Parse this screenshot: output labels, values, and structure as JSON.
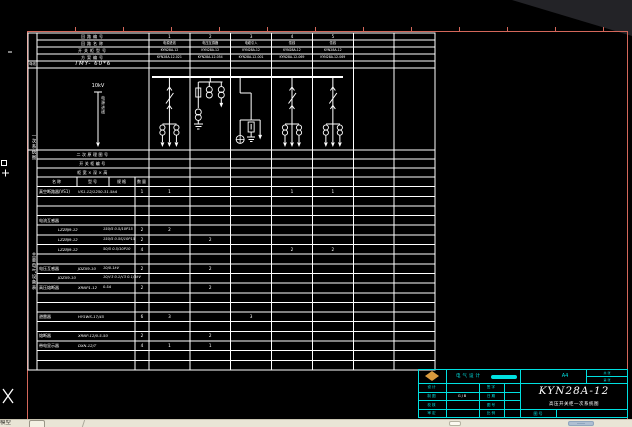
{
  "app": {
    "model_tab_label": "模型"
  },
  "colors": {
    "frame": "#d4675a",
    "drawing_lines": "#ffffff",
    "title_block": "#00e0e0",
    "logo": "#d99a3d",
    "taskbar": "#e9e5d6",
    "scroll_thumb": "#aebfd2"
  },
  "drawing": {
    "bus_label": "母线",
    "bus_spec": "TMY- 60*6",
    "incoming_voltage": "10kV",
    "incoming_note": "电源进线",
    "section_label_primary": "一次系统图",
    "section_label_equipment": "主要电气设备表",
    "header_rows": [
      {
        "label": "回路编号",
        "cells": [
          "1",
          "2",
          "3",
          "4",
          "5",
          "",
          ""
        ]
      },
      {
        "label": "回路名称",
        "cells": [
          "电源进线",
          "电压互感器",
          "电缆引入",
          "馈线",
          "馈线",
          "",
          ""
        ]
      },
      {
        "label": "开关柜型号",
        "cells": [
          "KYN28A-12",
          "KYN28A-12",
          "KYN28A-12",
          "KYN28A-12",
          "KYN28A-12",
          "",
          ""
        ]
      },
      {
        "label": "方案编号",
        "cells": [
          "KYN28A-12-021",
          "KYN28A-12-054",
          "KYN28A-12-001",
          "KYN28A-12-069",
          "KYN28A-12-069",
          "",
          ""
        ]
      }
    ],
    "scheme_diagrams": [
      "breaker",
      "pt",
      "cable",
      "breaker",
      "breaker",
      "",
      ""
    ],
    "info_rows": [
      {
        "label": "二次原理图号"
      },
      {
        "label": "开关柜编号"
      },
      {
        "label": "柜宽×深×高"
      }
    ],
    "equipment_headers": [
      "名称",
      "型号",
      "规格",
      "数量"
    ],
    "equipment_rows": [
      {
        "name": "真空断路器(VS1)",
        "model": "VS1-12/1250-31.5kA",
        "spec": "",
        "qty": "1",
        "per_scheme": [
          "1",
          "",
          "",
          "1",
          "1",
          "",
          ""
        ]
      },
      {
        "name": "",
        "model": "",
        "spec": "",
        "qty": "",
        "per_scheme": [
          "",
          "",
          "",
          "",
          "",
          "",
          ""
        ]
      },
      {
        "name": "",
        "model": "",
        "spec": "",
        "qty": "",
        "per_scheme": [
          "",
          "",
          "",
          "",
          "",
          "",
          ""
        ]
      },
      {
        "name": "电流互感器",
        "model": "",
        "spec": "",
        "qty": "",
        "per_scheme": [
          "",
          "",
          "",
          "",
          "",
          "",
          ""
        ]
      },
      {
        "name": "",
        "model": "LZZBJ9-12",
        "spec": "150/5  0.5/10P15",
        "qty": "2",
        "per_scheme": [
          "2",
          "",
          "",
          "",
          "",
          "",
          ""
        ]
      },
      {
        "name": "",
        "model": "LZZBJ9-12",
        "spec": "150/5  0.5S/10P15",
        "qty": "2",
        "per_scheme": [
          "",
          "2",
          "",
          "",
          "",
          "",
          ""
        ]
      },
      {
        "name": "",
        "model": "LZZBJ9-12",
        "spec": "50/5  0.5/10P10",
        "qty": "4",
        "per_scheme": [
          "",
          "",
          "",
          "2",
          "2",
          "",
          ""
        ]
      },
      {
        "name": "",
        "model": "",
        "spec": "",
        "qty": "",
        "per_scheme": [
          "",
          "",
          "",
          "",
          "",
          "",
          ""
        ]
      },
      {
        "name": "电压互感器",
        "model": "JDZX9-10",
        "spec": "10/0.1kV",
        "qty": "2",
        "per_scheme": [
          "",
          "2",
          "",
          "",
          "",
          "",
          ""
        ]
      },
      {
        "name": "",
        "model": "JDZX9-10",
        "spec": "10/√3 0.1/√3 0.1/3kV",
        "qty": "",
        "per_scheme": [
          "",
          "",
          "",
          "",
          "",
          "",
          ""
        ]
      },
      {
        "name": "高压熔断器",
        "model": "XRNP1-12",
        "spec": "0.5A",
        "qty": "2",
        "per_scheme": [
          "",
          "2",
          "",
          "",
          "",
          "",
          ""
        ]
      },
      {
        "name": "",
        "model": "",
        "spec": "",
        "qty": "",
        "per_scheme": [
          "",
          "",
          "",
          "",
          "",
          "",
          ""
        ]
      },
      {
        "name": "",
        "model": "",
        "spec": "",
        "qty": "",
        "per_scheme": [
          "",
          "",
          "",
          "",
          "",
          "",
          ""
        ]
      },
      {
        "name": "避雷器",
        "model": "HY5WS-17/45",
        "spec": "",
        "qty": "6",
        "per_scheme": [
          "3",
          "",
          "3",
          "",
          "",
          "",
          ""
        ]
      },
      {
        "name": "",
        "model": "",
        "spec": "",
        "qty": "",
        "per_scheme": [
          "",
          "",
          "",
          "",
          "",
          "",
          ""
        ]
      },
      {
        "name": "熔断器",
        "model": "XRNP-12/0.5-50",
        "spec": "",
        "qty": "2",
        "per_scheme": [
          "",
          "2",
          "",
          "",
          "",
          "",
          ""
        ]
      },
      {
        "name": "带电显示器",
        "model": "DXN-12/T",
        "spec": "",
        "qty": "4",
        "per_scheme": [
          "1",
          "1",
          "",
          "",
          "",
          "",
          ""
        ]
      },
      {
        "name": "",
        "model": "",
        "spec": "",
        "qty": "",
        "per_scheme": [
          "",
          "",
          "",
          "",
          "",
          "",
          ""
        ]
      },
      {
        "name": "",
        "model": "",
        "spec": "",
        "qty": "",
        "per_scheme": [
          "",
          "",
          "",
          "",
          "",
          "",
          ""
        ]
      }
    ]
  },
  "title_block": {
    "company": "电气设计",
    "sheet_size": "A4",
    "title": "KYN28A-12",
    "subtitle": "高压开关柜一次系统图",
    "fields": [
      {
        "label": "设计",
        "value": "",
        "label2": "签字",
        "value2": ""
      },
      {
        "label": "制图",
        "value": "GJB",
        "label2": "日期",
        "value2": ""
      },
      {
        "label": "校核",
        "value": "",
        "label2": "图号",
        "value2": ""
      },
      {
        "label": "审定",
        "value": "",
        "label2": "比例",
        "value2": ""
      }
    ],
    "pages_top": "共 张",
    "pages_bottom": "第 张",
    "bottom_label": "图号",
    "bottom_value": ""
  }
}
